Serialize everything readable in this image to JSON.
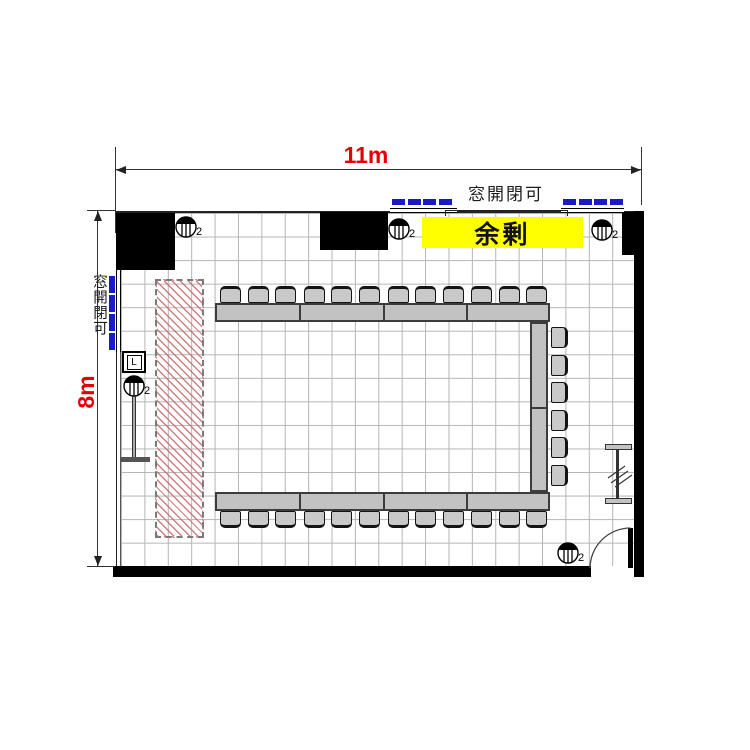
{
  "title": "meeting room floor plan",
  "dimensions": {
    "width_label": "11m",
    "height_label": "8m"
  },
  "windows": {
    "top_label": "窓開閉可",
    "left_label": "窓開閉可",
    "marker_color": "#1a1acc",
    "top_groups": [
      {
        "dashes": 4
      },
      {
        "dashes": 4
      }
    ],
    "left_group": {
      "dashes": 4
    }
  },
  "surplus": {
    "label": "余剰",
    "bg": "#ffff00"
  },
  "switch_box": {
    "label": "L"
  },
  "lights": {
    "lamp_count_label": "2",
    "positions": [
      {
        "name": "light-top-left",
        "x": 186,
        "y": 227
      },
      {
        "name": "light-top-center",
        "x": 399,
        "y": 229
      },
      {
        "name": "light-top-right",
        "x": 602,
        "y": 230
      },
      {
        "name": "light-left-wall",
        "x": 134,
        "y": 386
      },
      {
        "name": "light-bottom-right",
        "x": 568,
        "y": 553
      }
    ]
  },
  "furniture": {
    "layout": "U-shape open to the left",
    "top_row": {
      "table_segments": 4,
      "chairs": 12
    },
    "bottom_row": {
      "table_segments": 4,
      "chairs": 12
    },
    "right_column": {
      "table_segments": 2,
      "chairs": 6
    },
    "total_chairs": 30
  },
  "colors": {
    "dimension_text": "#e60005",
    "wall": "#000000",
    "grid_line": "#b4b4b4",
    "table_fill": "#c2c2c2",
    "hatch_line": "#c56a6a",
    "window_marker": "#1a1acc",
    "surplus_bg": "#ffff00"
  }
}
